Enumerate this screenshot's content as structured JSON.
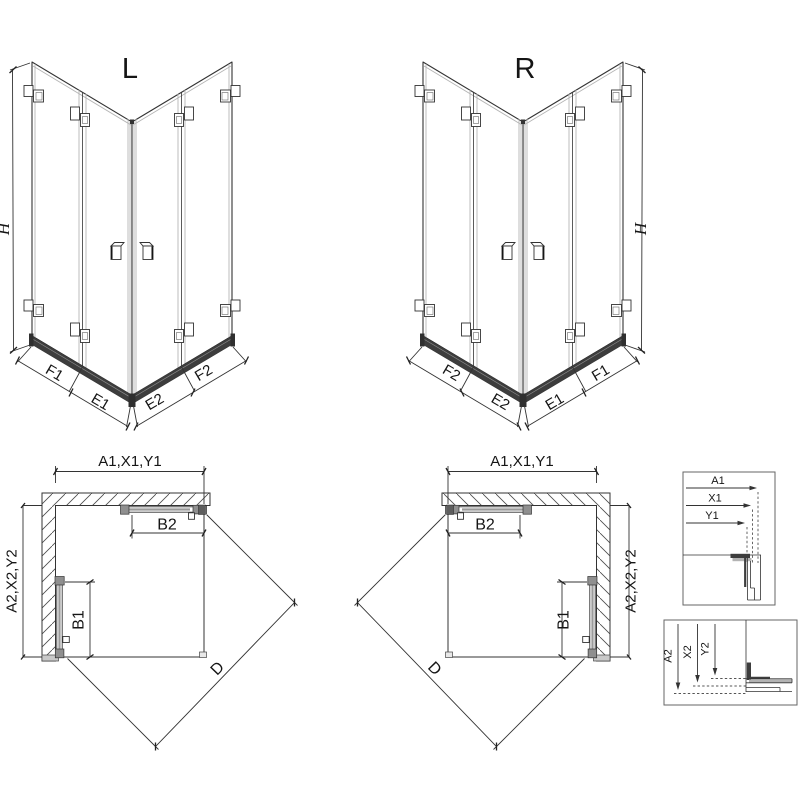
{
  "views": {
    "iso_left": {
      "label": "L",
      "height_dim": "H",
      "base_dims": {
        "outer_left": "F1",
        "inner_left": "E1",
        "inner_right": "E2",
        "outer_right": "F2"
      }
    },
    "iso_right": {
      "label": "R",
      "height_dim": "H",
      "base_dims": {
        "outer_left": "F2",
        "inner_left": "E2",
        "inner_right": "E1",
        "outer_right": "F1"
      }
    },
    "plan_left": {
      "width_dim": "A1,X1,Y1",
      "depth_dim": "A2,X2,Y2",
      "top_door_dim": "B2",
      "side_door_dim": "B1",
      "diagonal_dim": "D"
    },
    "plan_right": {
      "width_dim": "A1,X1,Y1",
      "depth_dim": "A2,X2,Y2",
      "top_door_dim": "B2",
      "side_door_dim": "B1",
      "diagonal_dim": "D"
    },
    "detail_width": {
      "dims": [
        "A1",
        "X1",
        "Y1"
      ]
    },
    "detail_depth": {
      "dims": [
        "A2",
        "X2",
        "Y2"
      ]
    }
  },
  "colors": {
    "line": "#333333",
    "glass_edge": "#b5b5b5",
    "rail": "#3d3d3d",
    "hardware": "#8f8f8f",
    "wall_foot": "#c9c9c9",
    "background": "#ffffff"
  }
}
